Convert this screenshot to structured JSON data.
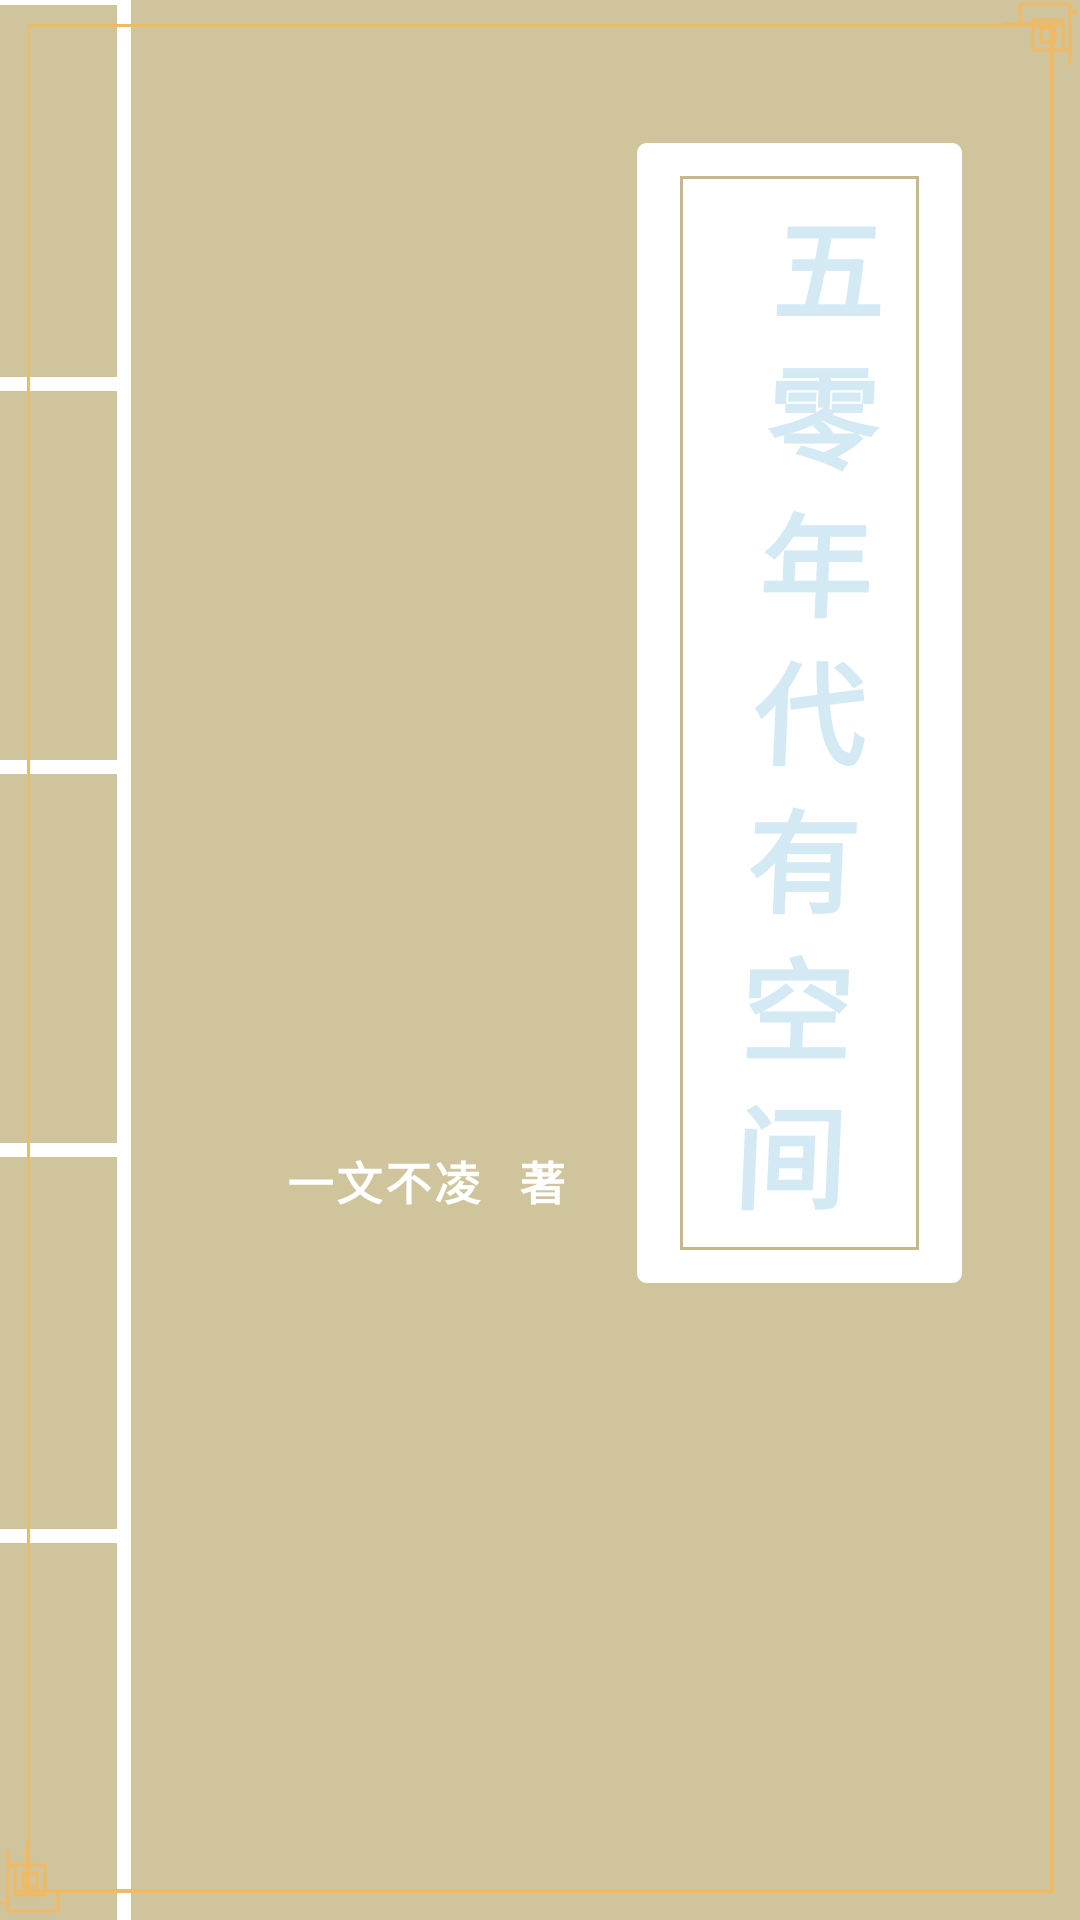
{
  "cover": {
    "title": "五零年代有空间",
    "author": "一文不凌",
    "author_role": "著"
  },
  "icons": {
    "top_right_ornament": "fret-corner-ornament",
    "bottom_left_ornament": "fret-corner-ornament"
  },
  "colors": {
    "background": "#cfc49c",
    "frame": "#f0b964",
    "title_text": "#d3e9f3",
    "label_bg": "#ffffff",
    "label_border": "#c5b98c",
    "spine": "#ffffff",
    "author_text": "#ffffff"
  }
}
